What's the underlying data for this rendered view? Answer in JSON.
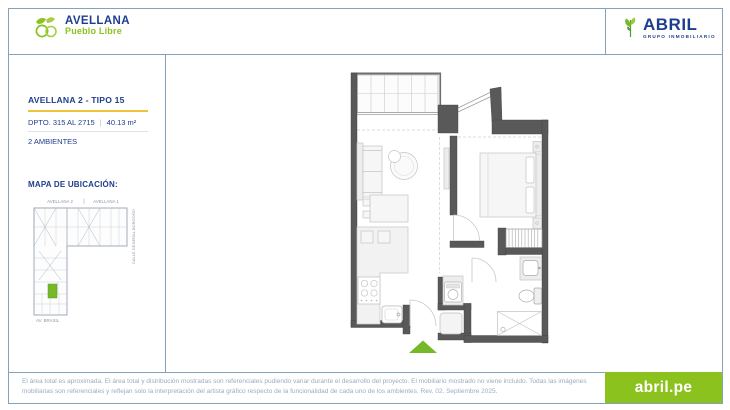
{
  "header": {
    "project_logo": {
      "name": "AVELLANA",
      "district": "Pueblo Libre"
    },
    "company_logo": {
      "name": "ABRIL",
      "tagline": "GRUPO INMOBILIARIO"
    }
  },
  "unit": {
    "title": "AVELLANA 2 - TIPO 15",
    "dpto": "DPTO. 315 AL 2715",
    "separator": "|",
    "area": "40.13 m²",
    "ambientes": "2 AMBIENTES"
  },
  "map": {
    "title": "MAPA DE UBICACIÓN:",
    "building_left": "AVELLANA 2",
    "building_right": "AVELLANA 1",
    "street_side": "CALLE GENERAL BORGOÑO",
    "street_bottom": "AV. BRASIL"
  },
  "footer": {
    "disclaimer": "El área total es aproximada. El área total y distribución mostradas son referenciales pudiendo variar durante el desarrollo del proyecto. El mobiliario mostrado no viene incluido. Todas las imágenes mobiliarias son referenciales y reflejan solo la interpretación del artista gráfico respecto de la funcionalidad de cada uno de los ambientes. Rev. 02. Septiembre 2025.",
    "website": "abril.pe"
  },
  "colors": {
    "navy": "#1F3D8F",
    "green": "#8CC21E",
    "entrance_marker": "#76B82A",
    "frame": "#86A2BB"
  }
}
